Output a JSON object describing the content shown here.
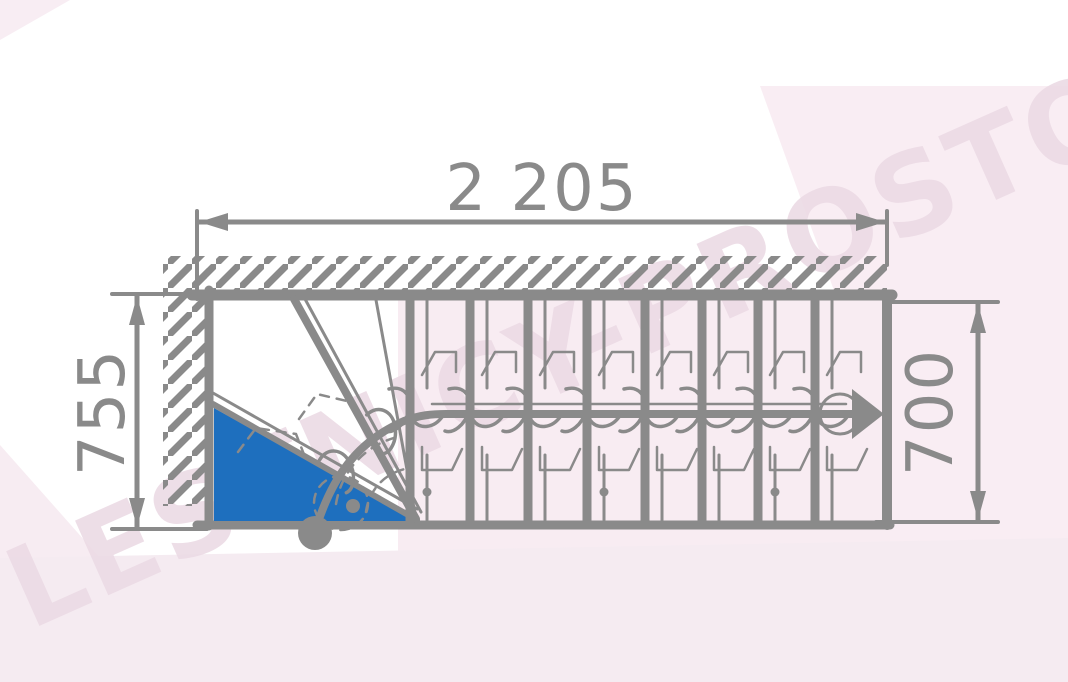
{
  "drawing": {
    "type": "staircase-plan-top-view",
    "dimensions": {
      "total_length": "2 205",
      "left_width": "755",
      "right_width": "700"
    },
    "stair": {
      "straight_tread_count": 8,
      "winder_tread_count": 3,
      "walk_direction": "right",
      "first_step_highlighted": true
    },
    "colors": {
      "line_gray": "#8a8a8a",
      "step_highlight_blue": "#1e6fbe",
      "watermark_text_pink": "#ecdbe5",
      "watermark_band_pink": "#f8ecf2"
    },
    "watermark": "LESTNICY-PROSTO.RU"
  }
}
